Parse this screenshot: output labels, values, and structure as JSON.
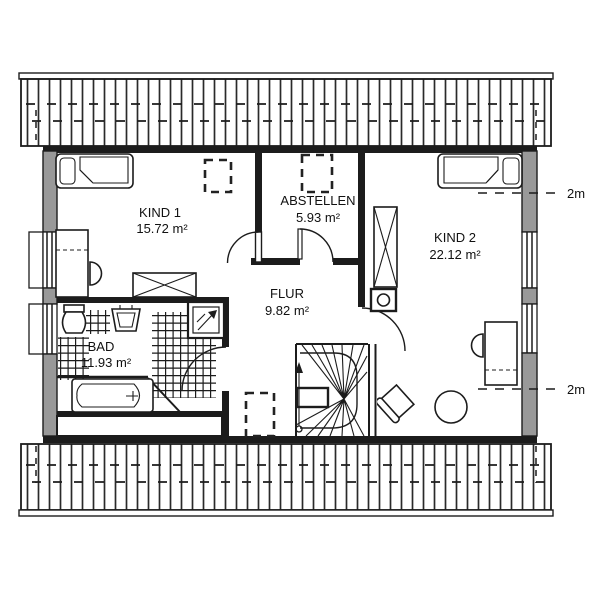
{
  "plan": {
    "rooms": [
      {
        "id": "kind1",
        "name": "KIND 1",
        "area": "15.72 m²"
      },
      {
        "id": "abstellen",
        "name": "ABSTELLEN",
        "area": "5.93 m²"
      },
      {
        "id": "kind2",
        "name": "KIND 2",
        "area": "22.12 m²"
      },
      {
        "id": "flur",
        "name": "FLUR",
        "area": "9.82 m²"
      },
      {
        "id": "bad",
        "name": "BAD",
        "area": "11.93 m²"
      }
    ],
    "height_marker_label": "2m",
    "colors": {
      "wall_gray": "#999999",
      "line_dark": "#1c1c1c",
      "background": "#ffffff"
    }
  }
}
